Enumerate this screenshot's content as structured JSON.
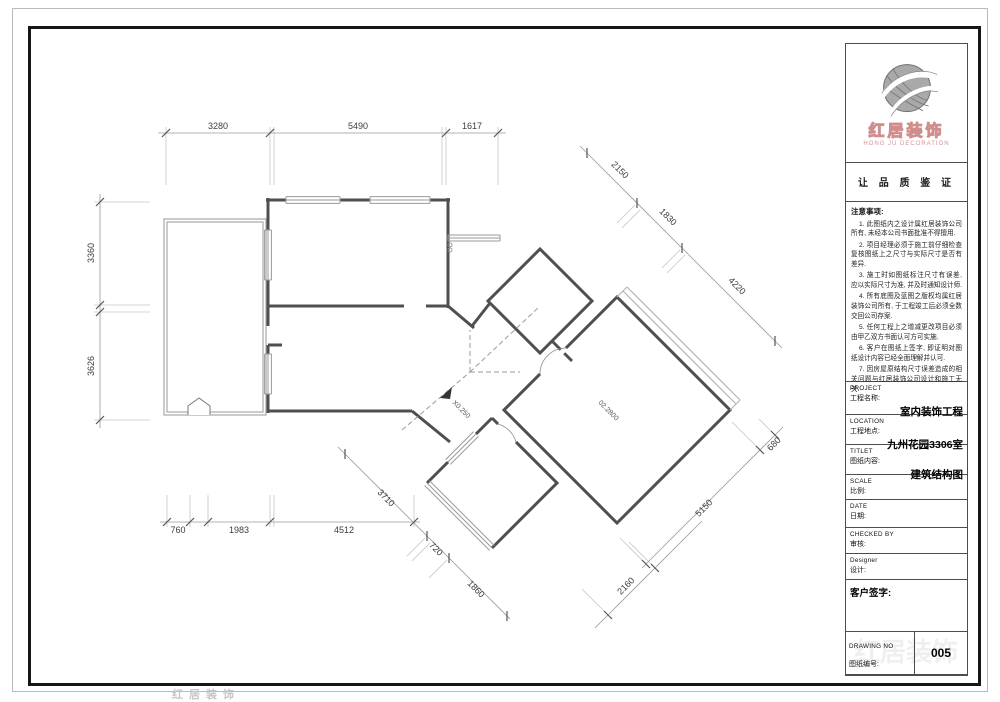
{
  "colors": {
    "wall": "#4f4f4f",
    "window": "#9a9a9a",
    "dim_line": "#9a9a9a",
    "frame": "#161616",
    "logo_red": "#cf8d8d"
  },
  "logo": {
    "company_cn": "红居装饰",
    "company_en": "HONG JU DECORATION",
    "slogan": "让 品 质 鉴 证"
  },
  "notes": {
    "title": "注意事项:",
    "items": [
      "1. 此图纸内之设计属红居装饰公司所有, 未经本公司书面批准不得擅用.",
      "2. 项目经理必须于施工前仔细检查复核图纸上之尺寸与实际尺寸是否有差异.",
      "3. 施工时如图纸标注尺寸有误差, 应以实际尺寸为准, 并及时通知设计师.",
      "4. 所有底图及蓝图之版权均属红居装饰公司所有, 于工程竣工后必须全数交回公司存案.",
      "5. 任何工程上之增减更改项目必须由甲乙双方书面认可方可实施.",
      "6. 客户在图纸上签字, 即证明对图纸设计内容已经全面理解并认可.",
      "7. 因房屋原结构尺寸误差造成的相关问题与红居装饰公司设计和施工无关."
    ]
  },
  "title_block": {
    "project_en": "PROJECT",
    "project_cn": "工程名称:",
    "project_value": "室内装饰工程",
    "location_en": "LOCATION",
    "location_cn": "工程地点:",
    "location_value": "九州花园3306室",
    "titlet_en": "TITLET",
    "titlet_cn": "图纸内容:",
    "titlet_value": "建筑结构图",
    "scale_en": "SCALE",
    "scale_cn": "比例:",
    "date_en": "DATE",
    "date_cn": "日期:",
    "checked_en": "CHECKED  BY",
    "checked_cn": "审核:",
    "designer_en": "Designer",
    "designer_cn": "设计:",
    "client_sign": "客户签字:",
    "drawing_no_en": "DRAWING  NO",
    "drawing_no_cn": "图纸编号:",
    "drawing_no_value": "005"
  },
  "plan": {
    "elevation_label": "X0.250",
    "room_label": "02.2800",
    "dims": {
      "top": [
        "3280",
        "5490",
        "1617"
      ],
      "left": [
        "3360",
        "3626"
      ],
      "bottom": [
        "760",
        "1983",
        "4512"
      ],
      "diag_ne": [
        "2150",
        "1830",
        "4220"
      ],
      "diag_se": [
        "680",
        "5150"
      ],
      "diag_sw": [
        "3710",
        "720",
        "1860"
      ],
      "diag_s": [
        "2160"
      ]
    }
  },
  "watermark": "红居装饰"
}
